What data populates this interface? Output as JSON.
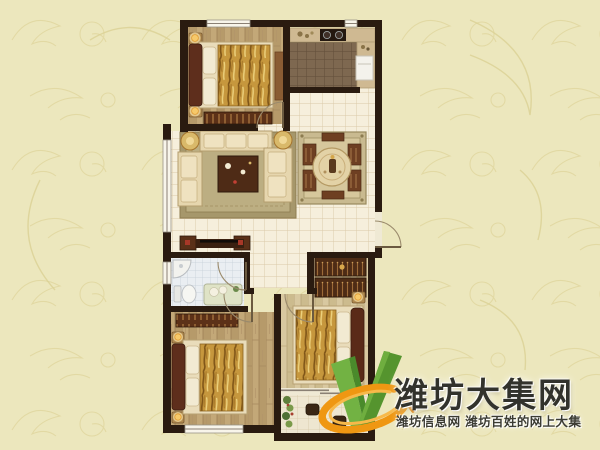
{
  "watermark": {
    "title": "潍坊大集网",
    "subtitle": "潍坊信息网 潍坊百姓的网上大集"
  },
  "logo": {
    "check_green": "#6fae3f",
    "check_green_dark": "#4a8a2b",
    "swoosh_orange": "#ef9712",
    "swoosh_highlight": "#f7b94a"
  },
  "palette": {
    "background": "#ece7bd",
    "damask_line": "#ded399",
    "wall": "#2a1b10",
    "tile_floor": "#f6efdc",
    "tile_grid": "#dac9a7",
    "kitchen_floor": "#7e6850",
    "wood_floor": "#c3a878",
    "wood_floor_light": "#d8c8a0",
    "bath_floor": "#eaeef2",
    "balcony_floor": "#eee6d0",
    "bedding_gold": "#c6973d",
    "sofa_cream": "#e6d6ae",
    "furniture_dark": "#4e2c15",
    "window_line": "#8a8074"
  },
  "floorplan": {
    "rooms": [
      {
        "id": "bedroom-top-left"
      },
      {
        "id": "kitchen"
      },
      {
        "id": "living-room"
      },
      {
        "id": "dining-area"
      },
      {
        "id": "entry-hall"
      },
      {
        "id": "bathroom"
      },
      {
        "id": "bedroom-bottom-left"
      },
      {
        "id": "bedroom-master"
      },
      {
        "id": "balcony"
      }
    ]
  }
}
